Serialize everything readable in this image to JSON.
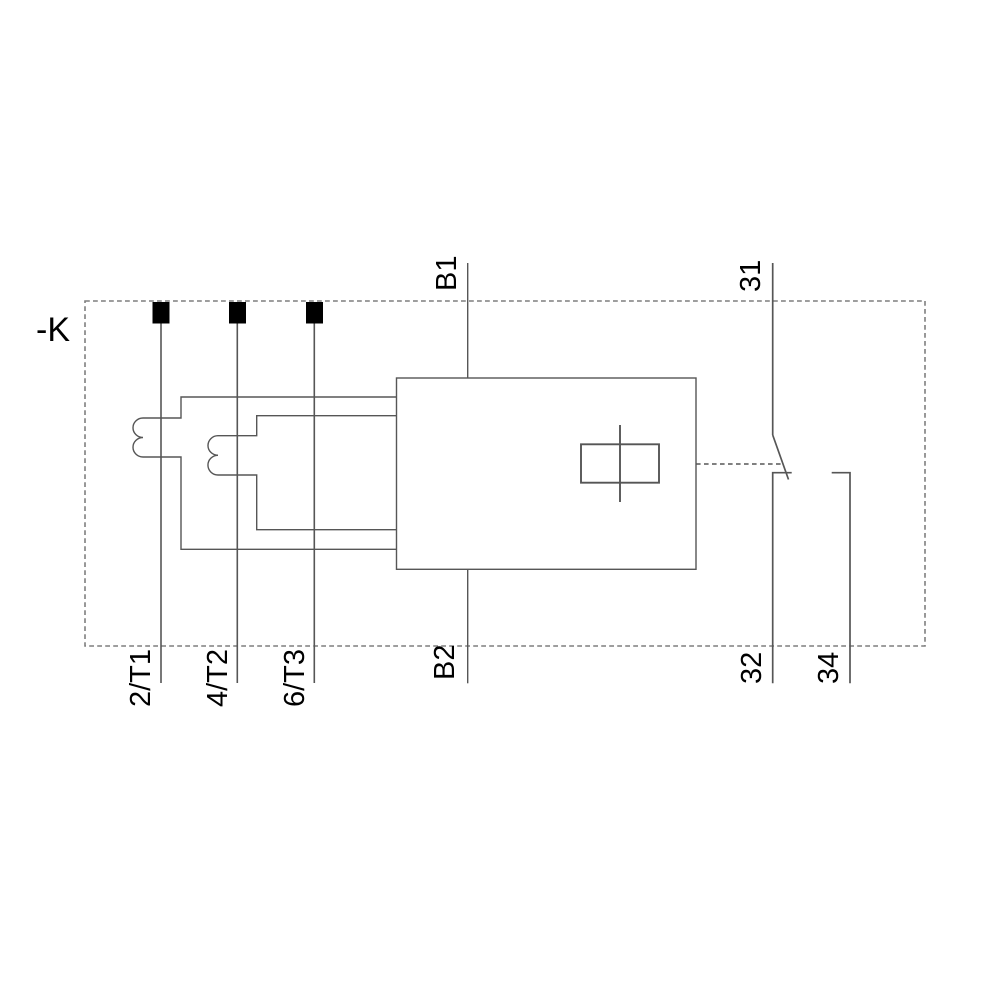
{
  "labels": {
    "device": "-K",
    "t1": "2/T1",
    "t2": "4/T2",
    "t3": "6/T3",
    "b1": "B1",
    "b2": "B2",
    "aux_common": "31",
    "aux_nc": "32",
    "aux_no": "34"
  },
  "colors": {
    "background": "#ffffff",
    "wire": "#565656",
    "boundary_dash": "#7f7f7f",
    "label": "#000000",
    "terminal_marker": "#000000"
  }
}
